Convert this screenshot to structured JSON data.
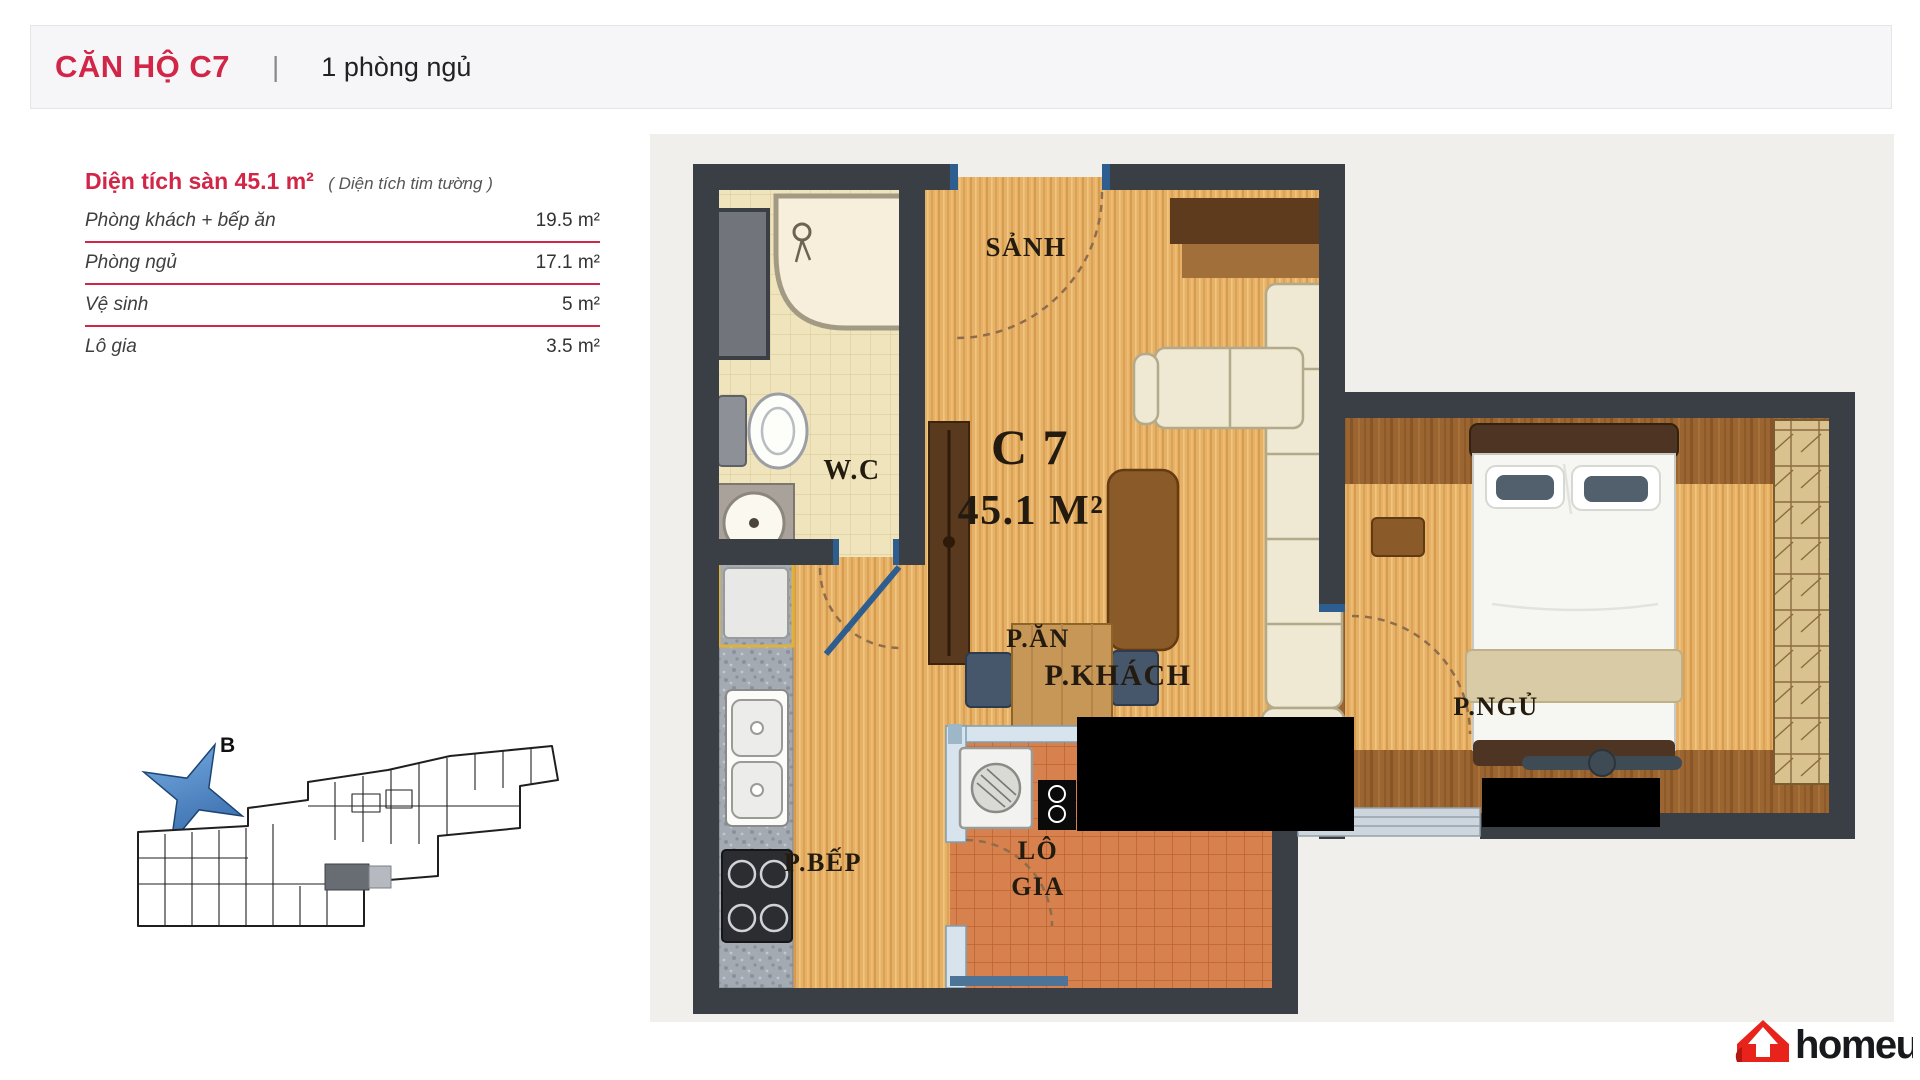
{
  "header": {
    "title": "CĂN HỘ C7",
    "divider": "|",
    "subtitle": "1 phòng ngủ"
  },
  "area_table": {
    "heading": "Diện tích sàn 45.1 m²",
    "note": "( Diện tích tim tường )",
    "rows": [
      {
        "label": "Phòng khách + bếp ăn",
        "value": "19.5 m²"
      },
      {
        "label": "Phòng ngủ",
        "value": "17.1 m²"
      },
      {
        "label": "Vệ sinh",
        "value": "5 m²"
      },
      {
        "label": "Lô gia",
        "value": "3.5 m²"
      }
    ]
  },
  "floor_plan": {
    "unit_code": "C 7",
    "unit_area": "45.1 M²",
    "rooms": {
      "hall": "SẢNH",
      "wc": "W.C",
      "living": "P.KHÁCH",
      "dining": "P.ĂN",
      "bedroom": "P.NGỦ",
      "kitchen": "P.BẾP",
      "balcony_line1": "LÔ",
      "balcony_line2": "GIA"
    }
  },
  "site_plan": {
    "compass_label": "B"
  },
  "logo": {
    "text": "homeup"
  },
  "colors": {
    "accent": "#d22648",
    "wall": "#3a3e45",
    "wood": "#e5b168",
    "terracotta": "#d6814e",
    "bath_tile": "#efe4bc",
    "plan_background": "#f0efeb",
    "logo_red": "#e8231c",
    "glass": "#d7e4ee",
    "door_jamb_blue": "#2e5d8f"
  }
}
